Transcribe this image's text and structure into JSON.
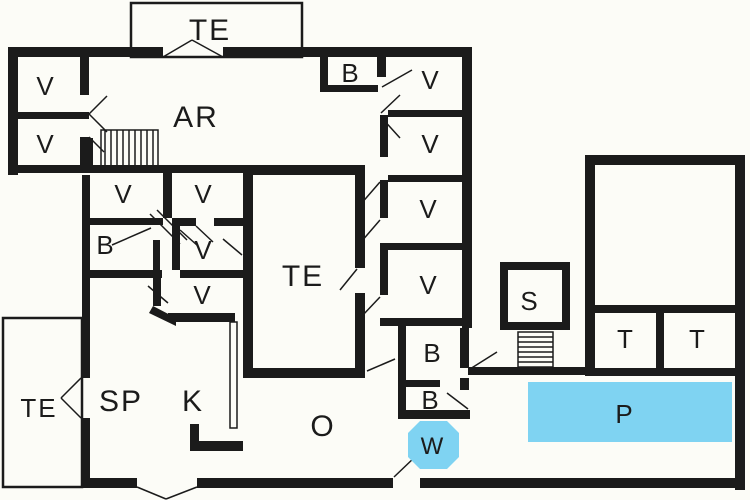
{
  "title": "Floor plan",
  "colors": {
    "floor": "#fcfcf7",
    "wall": "#1b1b1b",
    "water": "#7fd3f2",
    "ink": "#1b1b1b"
  },
  "rooms": {
    "te_balcony": {
      "label": "TE"
    },
    "v_left_top": {
      "label": "V"
    },
    "v_left_bottom": {
      "label": "V"
    },
    "ar": {
      "label": "AR"
    },
    "b_top": {
      "label": "B"
    },
    "v_right_1": {
      "label": "V"
    },
    "v_right_2": {
      "label": "V"
    },
    "v_right_3": {
      "label": "V"
    },
    "v_right_4": {
      "label": "V"
    },
    "v_mid_left": {
      "label": "V"
    },
    "v_mid_right": {
      "label": "V"
    },
    "b_mid": {
      "label": "B"
    },
    "v_mid_3": {
      "label": "V"
    },
    "v_mid_4": {
      "label": "V"
    },
    "te_inner": {
      "label": "TE"
    },
    "te_patio": {
      "label": "TE"
    },
    "sp": {
      "label": "SP"
    },
    "k": {
      "label": "K"
    },
    "o": {
      "label": "O"
    },
    "b_right_1": {
      "label": "B"
    },
    "b_right_2": {
      "label": "B"
    },
    "w": {
      "label": "W"
    },
    "s": {
      "label": "S"
    },
    "t_left": {
      "label": "T"
    },
    "t_right": {
      "label": "T"
    },
    "p": {
      "label": "P"
    }
  }
}
